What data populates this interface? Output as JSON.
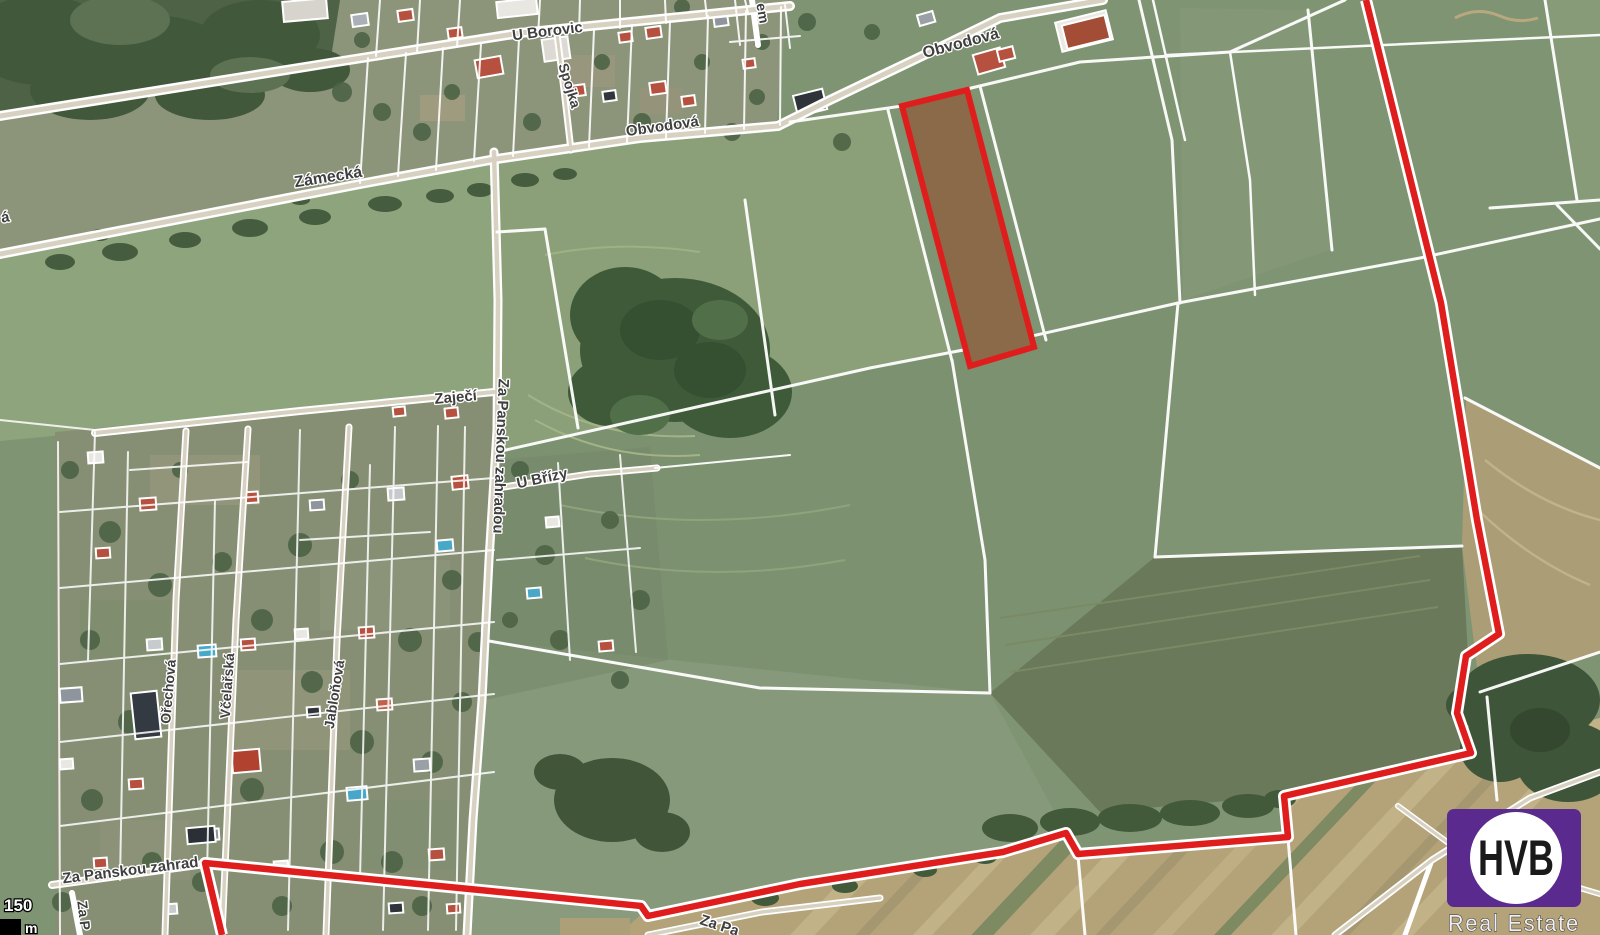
{
  "map": {
    "type": "satellite-cadastral",
    "street_labels": [
      {
        "id": "u-borovic",
        "text": "U Borovic"
      },
      {
        "id": "spojka",
        "text": "Spojka"
      },
      {
        "id": "obvodova-west",
        "text": "Obvodová"
      },
      {
        "id": "obvodova-east",
        "text": "Obvodová"
      },
      {
        "id": "zamecka",
        "text": "Zámecká"
      },
      {
        "id": "partial-left-edge",
        "text": "á"
      },
      {
        "id": "partial-top-edge",
        "text": "em"
      },
      {
        "id": "zajeci",
        "text": "Zaječí"
      },
      {
        "id": "u-brizy",
        "text": "U Břízy"
      },
      {
        "id": "za-panskou-zahradou-vertical",
        "text": "Za Panskou zahradou"
      },
      {
        "id": "orechova",
        "text": "Ořechová"
      },
      {
        "id": "vcelarska",
        "text": "Včelařská"
      },
      {
        "id": "jablonova",
        "text": "Jabloňová"
      },
      {
        "id": "za-panskou-zahradou-bottom",
        "text": "Za Panskou zahrad"
      },
      {
        "id": "partial-bottom-left",
        "text": "Za P"
      },
      {
        "id": "partial-bottom-center",
        "text": "Za Pa"
      }
    ],
    "scale_bar": {
      "value": "150",
      "unit": "m"
    },
    "highlight": {
      "parcel_fill": "#8a6a49",
      "boundary_color": "#e01d1d"
    }
  },
  "logo": {
    "brand": "HVB",
    "tagline": "Real Estate",
    "background": "#5a2a8e"
  }
}
